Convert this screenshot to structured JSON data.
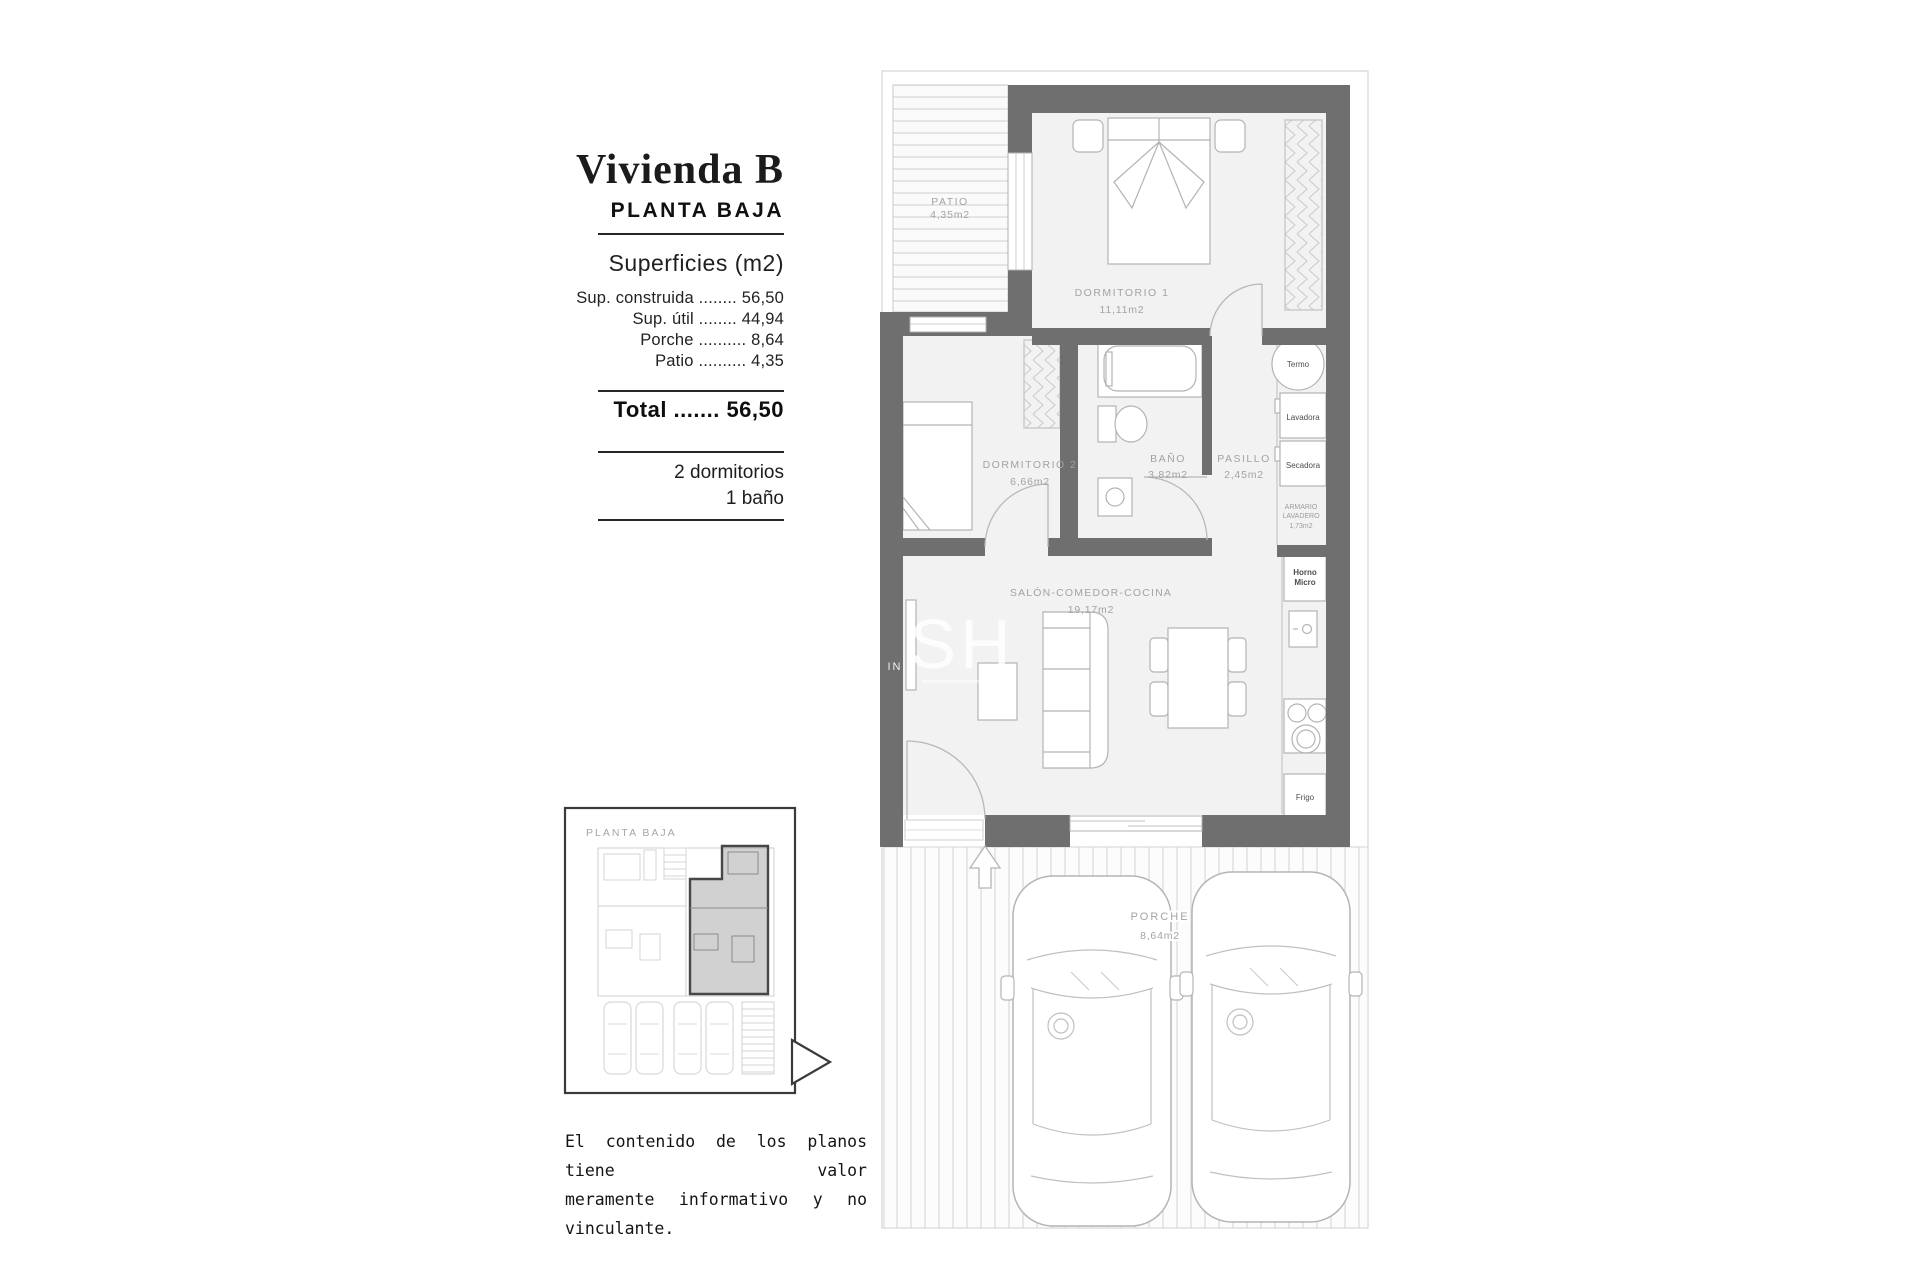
{
  "panel": {
    "title": "Vivienda B",
    "subtitle": "PLANTA BAJA",
    "surfaces_heading": "Superficies (m2)",
    "rows": [
      "Sup. construida ........ 56,50",
      "Sup. útil ........ 44,94",
      "Porche .......... 8,64",
      "Patio .......... 4,35"
    ],
    "total": "Total ....... 56,50",
    "features": [
      "2 dormitorios",
      "1 baño"
    ]
  },
  "plan": {
    "rooms": {
      "patio": {
        "name": "PATIO",
        "area": "4,35m2"
      },
      "dormitorio1": {
        "name": "DORMITORIO 1",
        "area": "11,11m2"
      },
      "dormitorio2": {
        "name": "DORMITORIO 2",
        "area": "6,66m2"
      },
      "bano": {
        "name": "BAÑO",
        "area": "3,82m2"
      },
      "pasillo": {
        "name": "PASILLO",
        "area": "2,45m2"
      },
      "salon": {
        "name": "SALÓN-COMEDOR-COCINA",
        "area": "19,17m2"
      },
      "porche": {
        "name": "PORCHE",
        "area": "8,64m2"
      }
    },
    "appliances": {
      "termo": "Termo",
      "lavadora": "Lavadora",
      "secadora": "Secadora",
      "armario_line1": "ARMARIO",
      "armario_line2": "LAVADERO",
      "armario_line3": "1,73m2",
      "horno_line1": "Horno",
      "horno_line2": "Micro",
      "frigo": "Frigo"
    },
    "watermark": {
      "main": "SH",
      "side": "IN"
    }
  },
  "inset": {
    "label": "PLANTA BAJA"
  },
  "disclaimer": {
    "line1": "El contenido de los planos tiene valor",
    "line2": "meramente informativo y no vinculante."
  },
  "colors": {
    "wall": "#6f6f6f",
    "floor": "#f2f2f2",
    "rule": "#262626",
    "room_label": "#a3a3a3"
  }
}
